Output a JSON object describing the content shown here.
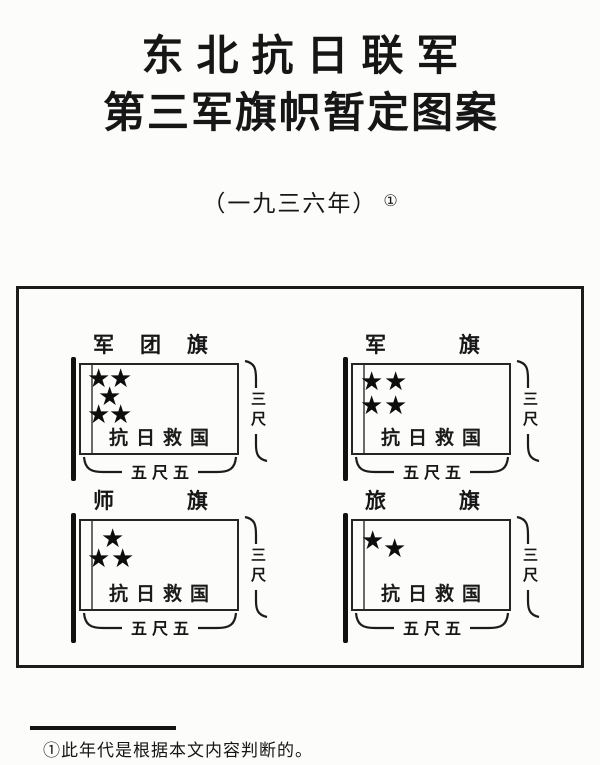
{
  "title": {
    "line1": "东北抗日联军",
    "line2": "第三军旗帜暂定图案"
  },
  "subtitle": {
    "text": "（一九三六年）",
    "note_ref": "①"
  },
  "star_glyph": "★",
  "flags": [
    {
      "id": "corps",
      "label": "军团旗",
      "star_count": 5,
      "stars": [
        {
          "x": 6,
          "y": 0
        },
        {
          "x": 28,
          "y": 0
        },
        {
          "x": 17,
          "y": 18
        },
        {
          "x": 6,
          "y": 36
        },
        {
          "x": 28,
          "y": 36
        }
      ],
      "slogan": "抗日救国",
      "height_label": "三尺",
      "width_label": "五尺五"
    },
    {
      "id": "army",
      "label": "军旗",
      "star_count": 4,
      "stars": [
        {
          "x": 7,
          "y": 3
        },
        {
          "x": 31,
          "y": 3
        },
        {
          "x": 7,
          "y": 27
        },
        {
          "x": 31,
          "y": 27
        }
      ],
      "slogan": "抗日救国",
      "height_label": "三尺",
      "width_label": "五尺五"
    },
    {
      "id": "division",
      "label": "师旗",
      "star_count": 3,
      "stars": [
        {
          "x": 20,
          "y": 4
        },
        {
          "x": 6,
          "y": 24
        },
        {
          "x": 30,
          "y": 24
        }
      ],
      "slogan": "抗日救国",
      "height_label": "三尺",
      "width_label": "五尺五"
    },
    {
      "id": "brigade",
      "label": "旅旗",
      "star_count": 2,
      "stars": [
        {
          "x": 8,
          "y": 6
        },
        {
          "x": 30,
          "y": 14
        }
      ],
      "slogan": "抗日救国",
      "height_label": "三尺",
      "width_label": "五尺五"
    }
  ],
  "footnote": {
    "marker": "①",
    "text": "此年代是根据本文内容判断的。"
  },
  "colors": {
    "ink": "#161616",
    "paper": "#fcfcfa"
  }
}
